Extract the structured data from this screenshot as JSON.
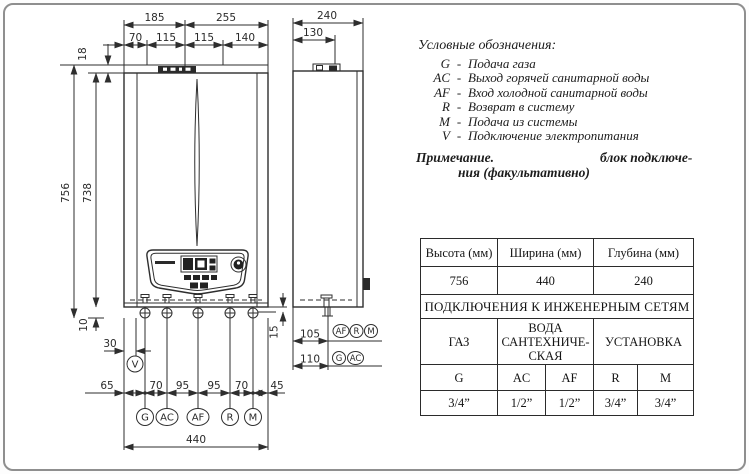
{
  "page": {
    "border_color": "#8f8f8f",
    "line_color": "#2e2e2e"
  },
  "drawing": {
    "front_dims": {
      "top_w1": "185",
      "top_w2": "255",
      "sub_w1": "70",
      "sub_w2": "115",
      "sub_w3": "115",
      "sub_w4": "140",
      "band_h": "18",
      "total_h": "756",
      "body_h": "738",
      "off_left": "10",
      "off_right": "15",
      "power_off": "30",
      "bot_1": "65",
      "bot_2": "70",
      "bot_3": "95",
      "bot_4": "95",
      "bot_5": "70",
      "bot_6": "45",
      "total_w": "440"
    },
    "side_dims": {
      "depth": "240",
      "bracket": "130",
      "row1_off": "105",
      "row2_off": "110"
    },
    "front_ports": [
      "G",
      "AC",
      "AF",
      "R",
      "M"
    ],
    "side_ports_row1": [
      "AF",
      "R",
      "M"
    ],
    "side_ports_row2": [
      "G",
      "AC"
    ],
    "power_label": "V"
  },
  "legend": {
    "title": "Условные обозначения:",
    "separator": "-",
    "items": [
      {
        "key": "G",
        "desc": "Подача газа"
      },
      {
        "key": "AC",
        "desc": "Выход горячей санитарной воды"
      },
      {
        "key": "AF",
        "desc": "Вход холодной санитарной воды"
      },
      {
        "key": "R",
        "desc": "Возврат в систему"
      },
      {
        "key": "M",
        "desc": "Подача из системы"
      },
      {
        "key": "V",
        "desc": "Подключение электропитания"
      }
    ],
    "note_label": "Примечание.",
    "note_rest": "блок подключе-",
    "note_line2": "ния (факультативно)"
  },
  "table": {
    "size_headers": [
      "Высота (мм)",
      "Ширина (мм)",
      "Глубина (мм)"
    ],
    "size_values": [
      "756",
      "440",
      "240"
    ],
    "section_title": "ПОДКЛЮЧЕНИЯ К ИНЖЕНЕРНЫМ СЕТЯМ",
    "group_headers": [
      "ГАЗ",
      "ВОДА САНТЕХНИЧЕ­СКАЯ",
      "УСТАНОВКА"
    ],
    "conn_labels": [
      "G",
      "AC",
      "AF",
      "R",
      "M"
    ],
    "conn_sizes": [
      "3/4”",
      "1/2”",
      "1/2”",
      "3/4”",
      "3/4”"
    ]
  }
}
